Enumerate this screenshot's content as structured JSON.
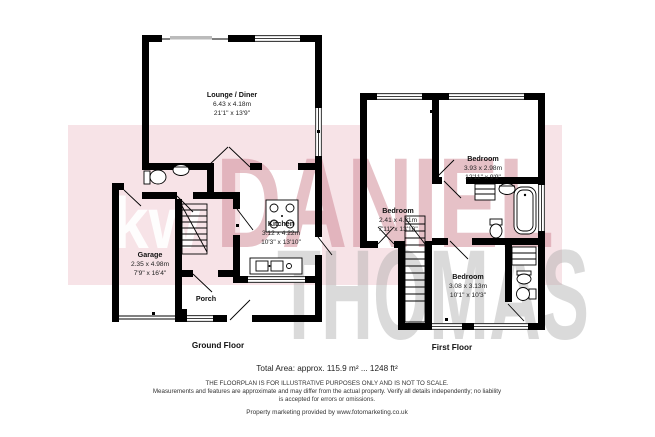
{
  "watermark": {
    "logo": "kw",
    "name_line1": "DANIEL",
    "name_line2": "THOMAS",
    "band_color": "#f7e3e7",
    "name1_color": "#d28f9b",
    "name2_color": "#a9a9a9"
  },
  "ground_floor": {
    "label": "Ground Floor",
    "lounge": {
      "name": "Lounge / Diner",
      "metric": "6.43 x 4.18m",
      "imperial": "21'1\" x 13'9\""
    },
    "kitchen": {
      "name": "Kitchen",
      "metric": "3.12 x 4.22m",
      "imperial": "10'3\" x 13'10\""
    },
    "garage": {
      "name": "Garage",
      "metric": "2.35 x 4.98m",
      "imperial": "7'9\" x 16'4\""
    },
    "porch": {
      "name": "Porch"
    }
  },
  "first_floor": {
    "label": "First Floor",
    "bedroom_left": {
      "name": "Bedroom",
      "metric": "2.41 x 4.21m",
      "imperial": "7'11\" x 13'10\""
    },
    "bedroom_top_right": {
      "name": "Bedroom",
      "metric": "3.93 x 2.98m",
      "imperial": "12'11\" x 9'9\""
    },
    "bedroom_bottom": {
      "name": "Bedroom",
      "metric": "3.08 x 3.13m",
      "imperial": "10'1\" x 10'3\""
    }
  },
  "footer": {
    "total_area": "Total Area: approx. 115.9 m² ... 1248 ft²",
    "disclaimer_line1": "THE FLOORPLAN IS FOR ILLUSTRATIVE PURPOSES ONLY AND IS NOT TO SCALE.",
    "disclaimer_line2": "Measurements and features are approximate and may differ from the actual property. Verify all details independently; no liability",
    "disclaimer_line3": "is accepted for errors or omissions.",
    "credit": "Property marketing provided by www.fotomarketing.co.uk"
  }
}
